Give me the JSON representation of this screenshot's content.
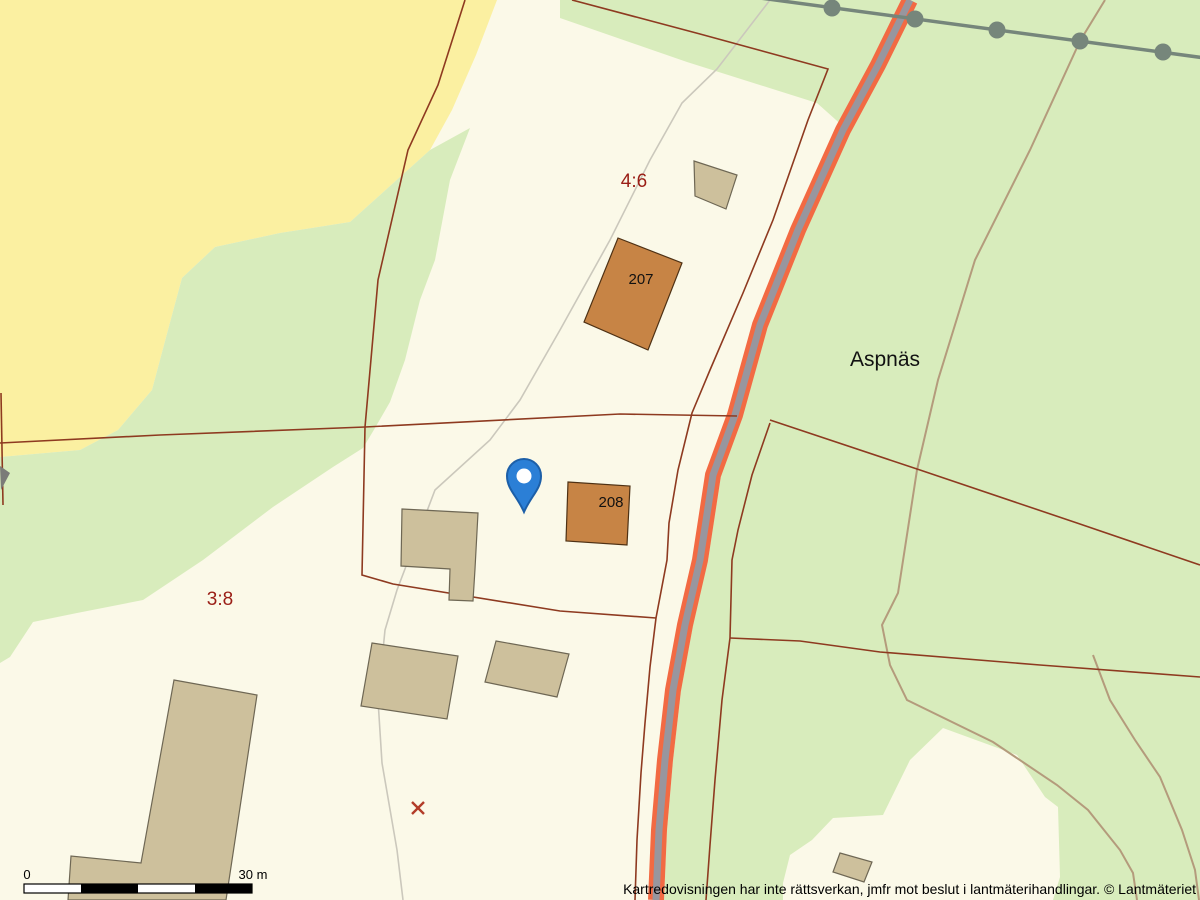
{
  "map": {
    "labels": {
      "parcel_46": "4:6",
      "parcel_38": "3:8",
      "place": "Aspnäs",
      "building_207": "207",
      "building_208": "208"
    },
    "scale_bar": {
      "start_label": "0",
      "end_label": "30 m"
    },
    "footer": {
      "disclaimer": "Kartredovisningen har inte rättsverkan, jmfr mot beslut i lantmäterihandlingar. © Lantmäteriet"
    },
    "markers": {
      "pin": "map-pin",
      "cross": "survey-cross"
    }
  },
  "colors": {
    "cream": "#fbf9e8",
    "field_yellow": "#fbf0a1",
    "forest_green": "#d8ecbc",
    "building_residential": "#c78445",
    "building_residential_outline": "#4e3114",
    "building_other": "#cdc09c",
    "building_other_outline": "#6e6754",
    "boundary_red": "#8e3a20",
    "label_red": "#9a1e16",
    "road_orange": "#f26a43",
    "road_gray": "#98969e",
    "power_line": "#76867b",
    "path_gray": "#cbc8bc",
    "path_brown": "#b49b7c",
    "pin_blue": "#2b7fd6",
    "pin_outline": "#1c5fa8",
    "marker_red": "#b23c28"
  }
}
